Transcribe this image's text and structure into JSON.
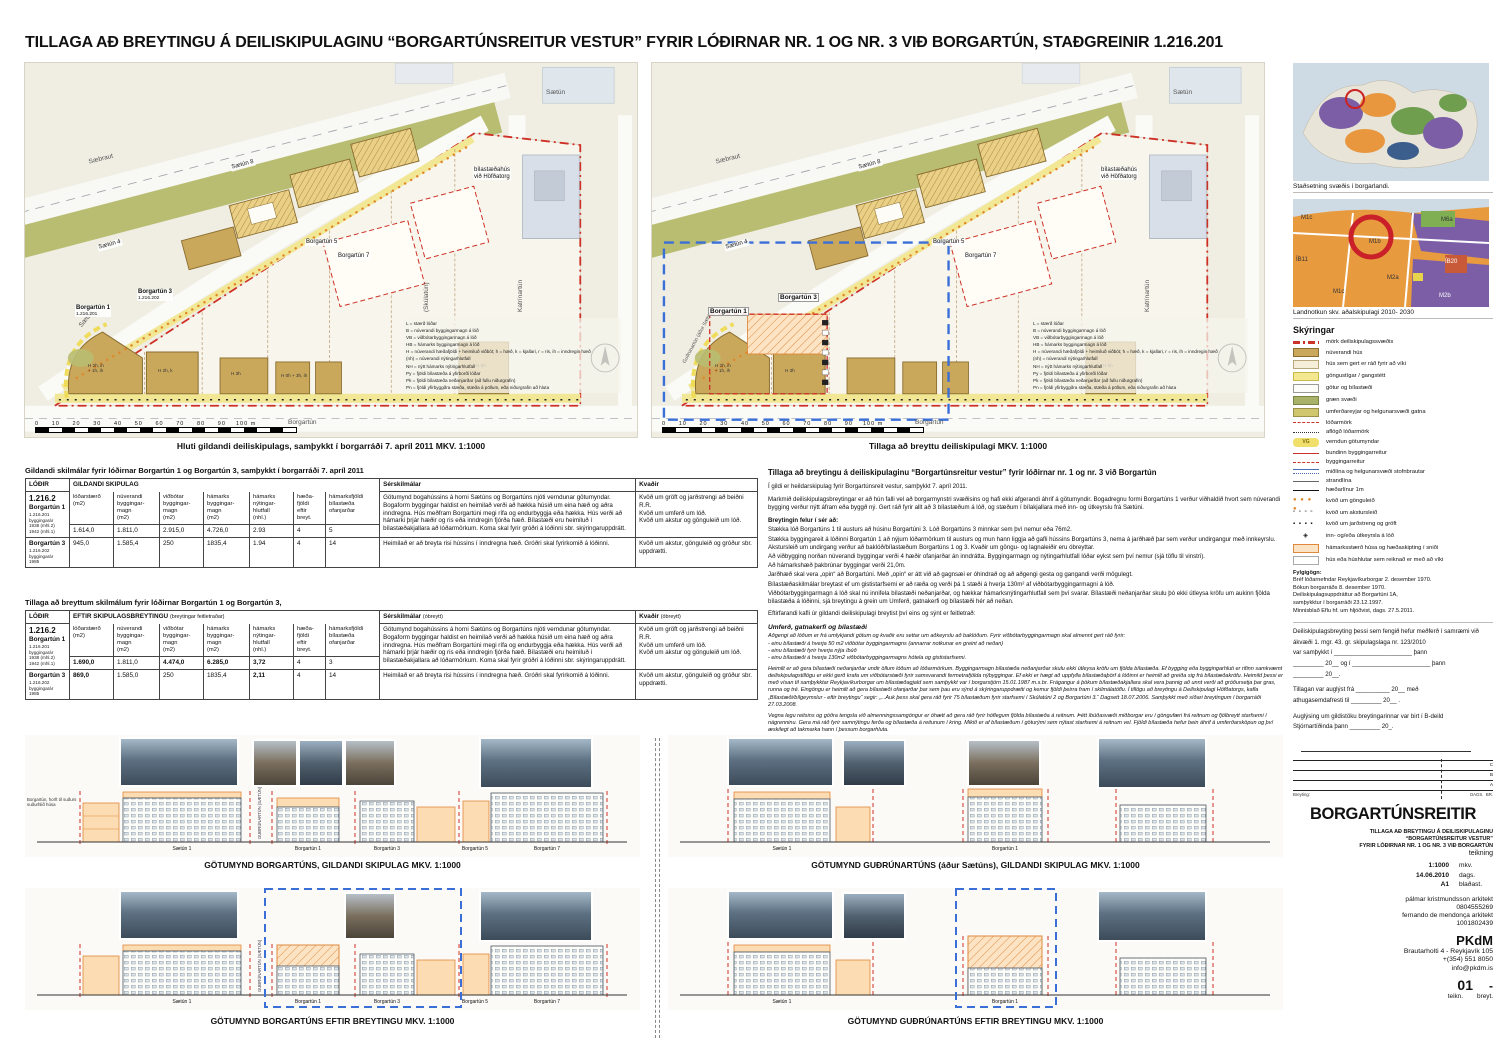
{
  "page": {
    "title": "TILLAGA AÐ BREYTINGU Á DEILISKIPULAGINU “BORGARTÚNSREITUR VESTUR” FYRIR LÓÐIRNAR NR. 1 OG NR. 3 VIÐ BORGARTÚN, STAÐGREINIR 1.216.201"
  },
  "maps": {
    "left_caption": "Hluti gildandi deiliskipulags, samþykkt í borgarráði 7. apríl 2011   MKV. 1:1000",
    "right_caption": "Tillaga að breyttu deiliskipulagi   MKV. 1:1000",
    "streets": {
      "saebraut": "Sæbraut",
      "saetun": "Sætún",
      "borgartun": "Borgartún",
      "katrinartun": "Katrínartún",
      "skulatun": "(Skúlatún)",
      "gudrunartun": "Guðrúnartún (áður Sætún)"
    },
    "lots": {
      "saetun4": "Sætún 4",
      "saetun8": "Sætún 8",
      "borgartun5": "Borgartún 5",
      "borgartun7": "Borgartún 7",
      "borgartun1": "Borgartún 1",
      "borgartun1_id": "1.216.201",
      "borgartun3": "Borgartún 3",
      "borgartun3_id": "1.216.202",
      "bilastaedahus": "bílastæðahús\nvið Höfðatorg"
    },
    "annotations": [
      "H 2h, k",
      "H 3h",
      "H 0h + 3h, ih",
      "H 2h, ih\n+ 1h, ih",
      "H 5h"
    ],
    "abbr_legend": [
      "L = stærð lóðar",
      "B = núverandi byggingarmagn á lóð",
      "VB = viðbótarbyggingarmagn á lóð",
      "HB = hámarks byggingarmagn á lóð",
      "H = núverandi hæðafjöldi + heimiluð viðbót; h = hæð, k = kjallari, r = ris, ih = inndregin hæð",
      "(nh) = núverandi nýtingarhlutfall",
      "NH = nýtt hámarks nýtingarhlutfall",
      "Py = fjöldi bílastæða á yfirborði lóðar",
      "Pk = fjöldi bílastæða neðanjarðar (að fullu niðurgrafin)",
      "Pn = fjöldi yfirbyggðra stæða, stæða á pöllum, eða niðurgrafin að hluta"
    ],
    "scale_numbers": "0     10     20     30     40     50     60     70     80     90    100 m"
  },
  "table1": {
    "title": "Gildandi skilmálar fyrir lóðirnar Borgartún 1 og Borgartún 3, samþykkt í borgarráði 7. apríl 2011",
    "col_lodir": "LÓÐIR",
    "group_header": "GILDANDI SKIPULAG",
    "group_note": "",
    "headers": [
      "lóðarstærð\n(m2)",
      "núverandi\nbyggingar-\nmagn\n(m2)",
      "viðbótar\nbyggingar-\nmagn\n(m2)",
      "hámarks\nbyggingar-\nmagn\n(m2)",
      "hámarks\nnýtingar-\nhlutfall\n(nhl.)",
      "hæða-\nfjöldi\neftir\nbreyt.",
      "hámarksfjöldi\nbílastæða\nofanjarðar"
    ],
    "ser_header": "Sérskilmálar",
    "ser_note": "",
    "kv_header": "Kvaðir",
    "kv_note": "",
    "zone": "1.216.2",
    "rows": [
      {
        "name": "Borgartún 1",
        "sub": "1.216.201\nbyggingarár\n1938 (mhl.2)\n1942 (mhl.1)",
        "values": [
          "1.614,0",
          "1.811,0",
          "2.915,0",
          "4.726,0",
          "2.93",
          "4",
          "5"
        ],
        "ser": "Götumynd bogahússins á horni Sætúns og Borgartúns njóti verndunar götumyndar. Bogaform byggingar haldist en heimilað verði að hækka húsið um eina hæð og aðra inndregna. Hús meðfram Borgartúni megi rífa og endurbyggja eða hækka. Hús verði að hámarki þrjár hæðir og ris eða inndregin fjórða hæð. Bílastæði eru heimiluð í bílastæðakjallara að lóðarmörkum. Koma skal fyrir gróðri á lóðinni sbr. skýringaruppdrátt.",
        "kv": "Kvöð um gröft og jarðstrengi að beiðni R.R.\nKvöð um umferð um lóð.\nKvöð um akstur og gönguleið um lóð."
      },
      {
        "name": "Borgartún 3",
        "sub": "1.216.202\nbyggingarár\n1985",
        "values": [
          "945,0",
          "1.585,4",
          "250",
          "1835,4",
          "1.94",
          "4",
          "14"
        ],
        "ser": "Heimilað er að breyta risi hússins í inndregna hæð. Gróðri skal fyrirkomið á lóðinni.",
        "kv": "Kvöð um akstur, gönguleið og gróður sbr. uppdrætti."
      }
    ]
  },
  "table2": {
    "title": "Tillaga að breyttum skilmálum fyrir lóðirnar Borgartún 1 og Borgartún 3,",
    "col_lodir": "LÓÐIR",
    "group_header": "EFTIR SKIPULAGSBREYTINGU",
    "group_note": "(breytingar feitletraðar)",
    "headers": [
      "lóðarstærð\n(m2)",
      "núverandi\nbyggingar-\nmagn\n(m2)",
      "viðbótar\nbyggingar-\nmagn\n(m2)",
      "hámarks\nbyggingar-\nmagn\n(m2)",
      "hámarks\nnýtingar-\nhlutfall\n(nhl.)",
      "hæða-\nfjöldi\neftir\nbreyt.",
      "hámarksfjöldi\nbílastæða\nofanjarðar"
    ],
    "ser_header": "Sérskilmálar",
    "ser_note": "(óbreytt)",
    "kv_header": "Kvaðir",
    "kv_note": "(óbreytt)",
    "zone": "1.216.2",
    "rows": [
      {
        "name": "Borgartún 1",
        "sub": "1.216.201\nbyggingarár\n1938 (mhl.2)\n1942 (mhl.1)",
        "values": [
          "1.690,0",
          "1.811,0",
          "4.474,0",
          "6.285,0",
          "3,72",
          "4",
          "3"
        ],
        "ser": "Götumynd bogahússins á horni Sætúns og Borgartúns njóti verndunar götumyndar. Bogaform byggingar haldist en heimilað verði að hækka húsið um eina hæð og aðra inndregna. Hús meðfram Borgartúni megi rífa og endurbyggja eða hækka. Hús verði að hámarki þrjár hæðir og ris eða inndregin fjórða hæð. Bílastæði eru heimiluð í bílastæðakjallara að lóðarmörkum. Koma skal fyrir gróðri á lóðinni sbr. skýringaruppdrátt.",
        "kv": "Kvöð um gröft og jarðstrengi að beiðni R.R.\nKvöð um umferð um lóð.\nKvöð um akstur og gönguleið um lóð."
      },
      {
        "name": "Borgartún 3",
        "sub": "1.216.202\nbyggingarár\n1985",
        "values": [
          "869,0",
          "1.585,0",
          "250",
          "1835,4",
          "2,11",
          "4",
          "14"
        ],
        "ser": "Heimilað er að breyta risi hússins í inndregna hæð. Gróðri skal fyrirkomið á lóðinni.",
        "kv": "Kvöð um akstur, gönguleið og gróður sbr. uppdrætti."
      }
    ]
  },
  "proposal": {
    "heading": "Tillaga að breytingu á deiliskipulaginu “Borgartúnsreitur vestur” fyrir lóðirnar nr. 1 og nr. 3 við Borgartún",
    "p1": "Í gildi er heildarskipulag fyrir Borgartúnsreit vestur, samþykkt 7. apríl 2011.",
    "p2": "Markmið deiliskipulagsbreytingar er að hún falli vel að borgarmynstri svæðisins og hafi ekki afgerandi áhrif á götumyndir. Bogadregnu formi Borgartúns 1 verður viðhaldið hvort sem núverandi bygging verður nýtt áfram eða byggð ný. Gert ráð fyrir allt að 3 bílastæðum á lóð, og stæðum í bílakjallara með inn- og útkeyrslu frá Sætúni.",
    "sub": "Breytingin felur í sér að:",
    "items": [
      "Stækka lóð Borgartúns 1 til austurs að húsinu Borgartúni 3. Lóð Borgartúns 3 minnkar sem því nemur eða 76m2.",
      "Stækka byggingareit á lóðinni Borgartún 1 að nýjum lóðarmörkum til austurs og mun hann liggja að gafli hússins Borgartúns 3, nema á jarðhæð þar sem verður undirgangur með innkeyrslu. Akstursleið um undirgang verður að baklóð/bílastæðum Borgartúns 1 og 3. Kvaðir um göngu- og lagnaleiðir eru óbreyttar.",
      "Að viðbygging norðan núverandi byggingar verði 4 hæðir ofanjarðar án inndrátta. Byggingarmagn og nýtingarhlutfall lóðar eykst sem því nemur (sjá töflu til vinstri).",
      "Að hámarkshæð þakbrúnar byggingar verði 21,0m.",
      "Jarðhæð skal vera „opin“ að Borgartúni. Með „opin“ er átt við að gagnsæi er óhindrað og að aðgengi gesta og gangandi verði mögulegt.",
      "Bílastæðaskilmálar breytast ef um gististarfsemi er að ræða og verði þá 1 stæði á hverja 130m² af viðbótarbyggingarmagni á lóð.",
      "Viðbótarbyggingarmagn á lóð skal nú innifela bílastæði neðanjarðar, og hækkar hámarksnýtingarhlutfall sem því svarar. Bílastæði neðanjarðar skulu þó ekki útleysa kröfu um aukinn fjölda bílastæða á lóðinni, sjá breytingu á grein um Umferð, gatnakerfi og bílastæði hér að neðan."
    ],
    "p3": "Eftirfarandi kafli úr gildandi deiliskipulagi breytist því eins og sýnt er feitletrað:",
    "u_heading": "Umferð, gatnakerfi og bílastæði",
    "u1": "Aðgengi að lóðum er frá umlykjandi götum og kvaðir eru settar um aðkeyrslu að baklóðum. Fyrir viðbótarbyggingarmagn skal almennt gert ráð fyrir:\n- einu bílastæði á hverja 50 m2 viðbótar byggingarmagns (annarrar notkunar en greint að neðan)\n- einu bílastæði fyrir hverja nýja íbúð\n- einu bílastæði á hverja 130m2 viðbótarbyggingarmagns hótela og gististarfsemi.",
    "u2": "Heimilt er að gera bílastæði neðanjarðar undir öllum lóðum að lóðarmörkum. Byggingarmagn bílastæða neðanjarðar skulu ekki útleysa kröfu um fjölda bílastæða. Ef bygging eða byggingarhluti er rifinn samkvæmt deiliskipulagstillögu er ekki gerð krafa um viðbótarstæði fyrir samsvarandi fermetrafjölda nýbyggingar. Ef ekki er hægt að uppfylla bílastæðaþörf á lóðinni er heimilt að greiða sig frá bílastæðakröfu. Heimild þessi er með vísan til samþykktar Reykjavíkurborgar um bílastæðagjald sem samþykkt var í borgarstjórn 15.01.1987 m.s.br. Frágangur á þökum bílastæðakjallara skal vera þannig að unnt verði að gróðursetja þar gras, runna og tré. Eingöngu er heimilt að gera bílastæði ofanjarðar þar sem þau eru sýnd á skýringaruppdrætti og kemur fjöldi þeirra fram í skilmálatöflu. Í tillögu að breytingu á Deiliskipulagi Höfðatorgs, kafla „Bílastæði/bílgeymslur - eftir breytingu“ segir: „...Auk þess skal gera ráð fyrir 75 bílastæðum fyrir starfsemi í Skúlatúni 2 og Borgartúni 3.“ Dagsett 18.07.2006. Samþykkt með síðari breytingum í borgarráði 27.03.2008.",
    "u3": "Vegna legu reitsins og góðra tengsla við almenningssamgöngur er óhætt að gera ráð fyrir hóflegum fjölda bílastæða á reitnum. Þétt íbúðasvæði miðborgar eru í göngufæri frá reitnum og fjölbreytt starfsemi í nágrenninu. Gera má ráð fyrir samnýtingu ferða og bílastæða á reitunum í kring. Mikið er af bílastæðum í göturými sem nýtast starfsemi á reitnum vel. Fjöldi bílastæða hefur bein áhrif á umferðarsköpun og því æskilegt að takmarka hann í þessum borgarhluta.",
    "final": "Að öðru leyti gilda ákvæði og skilmálar gildandi deiliskipulags."
  },
  "sidebar": {
    "map1_caption": "Staðsetning svæðis í borgarlandi.",
    "map2_caption": "Landnotkun skv. aðalskipulagi 2010- 2030",
    "map2_labels": [
      "M1c",
      "M6a",
      "M1b",
      "ÍB11",
      "ÍB20",
      "M2a",
      "M1c",
      "M2b"
    ],
    "legend_title": "Skýringar",
    "vg_mark": "VG",
    "glyph_dots": "● ● ● ●",
    "glyph_open_squares": "▫ ▫ ▫ ▫",
    "glyph_filled_squares": "▪ ▪ ▪ ▪",
    "glyph_diamond": "◈",
    "legend": [
      "mörk deiliskipulagssvæðis",
      "núverandi hús",
      "hús sem gert er ráð fyrir að víki",
      "göngustígar / gangstétt",
      "götur og bílastæði",
      "græn svæði",
      "umferðareyjar og helgunarsvæði gatna",
      "lóðarmörk",
      "aflögð lóðarmörk",
      "verndun götumyndar",
      "bundinn byggingarreitur",
      "byggingarreitur",
      "miðlína og helgunarsvæði stofnbrautar",
      "strandlína",
      "hæðarlínur 1m",
      "kvöð um gönguleið",
      "kvöð um akstursleið",
      "kvöð um jarðstreng og gröft",
      "inn- og/eða útkeyrsla á lóð",
      "hámarksstærð húsa og hæðaskipting í sniði",
      "hús eða húshlutar sem reiknað er með að víki"
    ],
    "fylgigogn_title": "Fylgigögn:",
    "fylgigogn": "Bréf lóðarnefndar Reykjavíkurborgar 2. desember 1970.\nBókun borgarráðs 8. desember 1970.\nDeiliskipulagsuppdráttur að Borgartúni 1A,\nsamþykktur í borgarráði 23.12.1997.\nMinnisblað Eflu hf. um hljóðvist, dags. 27.5.2011.",
    "approval": {
      "p1": "Deiliskipulagsbreyting þessi sem fengið hefur meðferð í samræmi við ákvæði 1. mgr. 43. gr. skipulagslaga nr. 123/2010",
      "l1": "var samþykkt í _______________________ þann",
      "l2": "_________ 20__  og  í  _______________________ þann",
      "l3": "_________ 20__.",
      "p2": "Tillagan var auglýst frá __________ 20__ með",
      "p2b": "athugasemdafresti til _________ 20__ .",
      "p3": "Auglýsing um gildistöku breytingarinnar var birt í B-deild",
      "p3b": "Stjórnartíðinda þann _________ 20_."
    },
    "revision": {
      "breyting": "Breyting:",
      "dags": "DAGS.",
      "br": "BR.",
      "rows": [
        "C",
        "B",
        "A"
      ]
    },
    "titleblock": {
      "project": "BORGARTÚNSREITIR",
      "subtitle": "TILLAGA AÐ BREYTINGU Á DEILISKIPULAGINU\n“BORGARTÚNSREITUR VESTUR”\nFYRIR LÓÐIRNAR NR. 1 OG NR. 3 VIÐ BORGARTÚN",
      "type": "teikning",
      "mkv_value": "1:1000",
      "mkv_label": "mkv.",
      "dags_value": "14.06.2010",
      "dags_label": "dags.",
      "blad_value": "A1",
      "blad_label": "blaðast.",
      "arch1": "pálmar kristmundsson arkitekt",
      "arch1_id": "0804555269",
      "arch2": "fernando de mendonça arkitekt",
      "arch2_id": "1001802439",
      "firm": "PKdM",
      "address": "Brautarholti 4  -  Reykjavík 105",
      "phone": "+(354)  551 8050",
      "email": "info@pkdm.is",
      "sheet": "01",
      "sheet_rev": "-",
      "sheet_label": "teikn.",
      "sheet_rev_label": "breyt."
    }
  },
  "elevations": {
    "captions": [
      "GÖTUMYND BORGARTÚNS, GILDANDI SKIPULAG MKV. 1:1000",
      "GÖTUMYND GUÐRÚNARTÚNS (áður Sætúns), GILDANDI SKIPULAG MKV. 1:1000",
      "GÖTUMYND BORGARTÚNS EFTIR BREYTINGU MKV. 1:1000",
      "GÖTUMYND GUÐRÚNARTÚNS EFTIR BREYTINGU MKV. 1:1000"
    ],
    "axis_label": "GUÐRÚNARTÚN (SÆTÚN)",
    "left_note": "Borgartún, horft til suðurs\nsuðurhlið húsa",
    "row1_labels": [
      "Sætún 1",
      "Borgartún 1",
      "Borgartún 3",
      "Borgartún 5",
      "Borgartún 7"
    ],
    "row2_labels": [
      "Sætún 1",
      "Borgartún 1"
    ]
  }
}
